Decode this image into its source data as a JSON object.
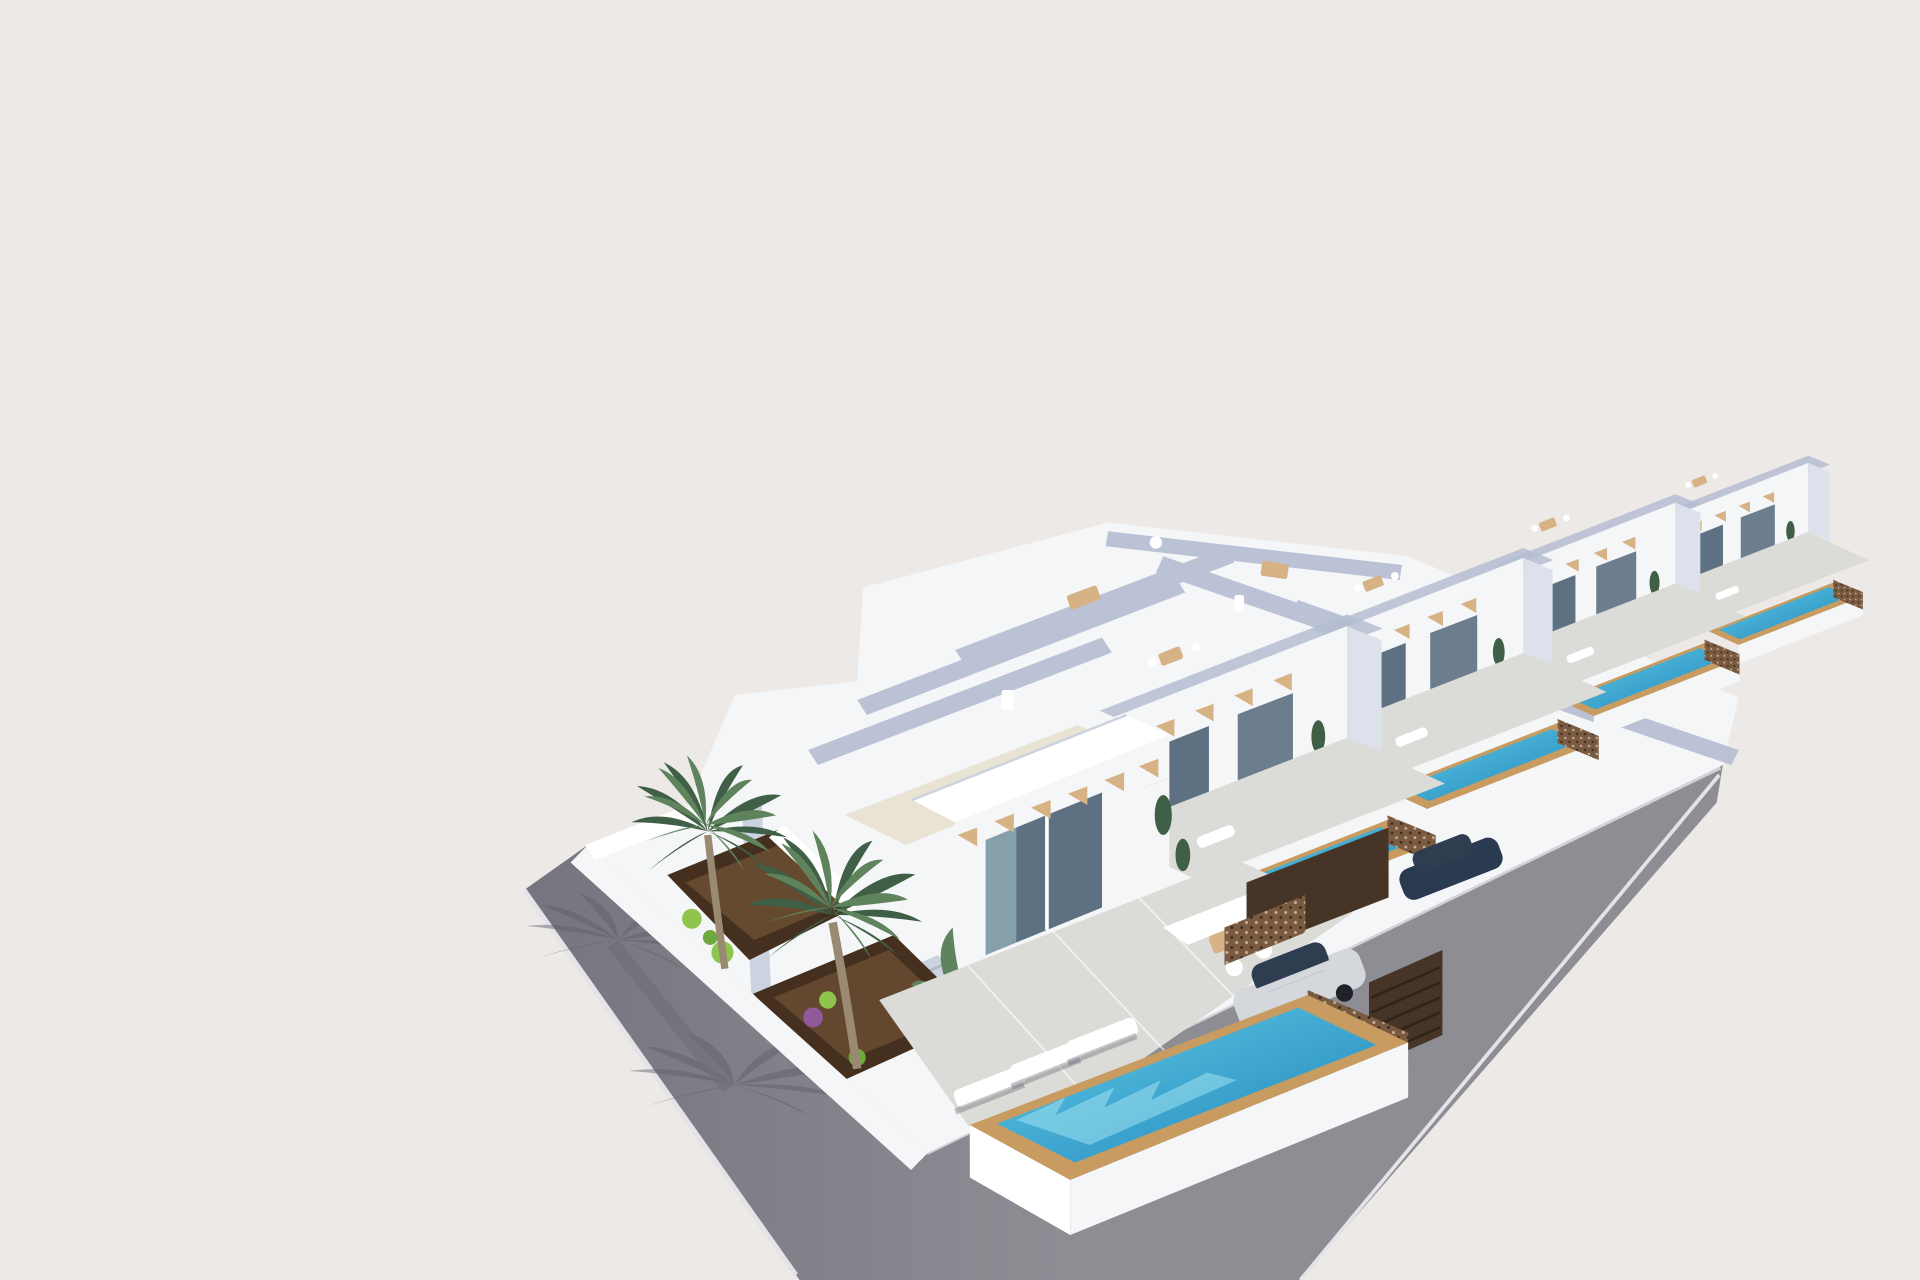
{
  "scene": {
    "title": "3D exterior rendering of a row of modern white villas with private pools beside a paved street",
    "elements": {
      "background": "plain warm-grey sky backdrop",
      "road": "grey paved street and sidewalk wrapping the corner of the plot",
      "palm_shadow": "palm tree shadows cast on the pavement",
      "villa_block": "row of five terraced white villas receding to the right",
      "villa_front": "nearest corner villa with garden, terrace and large pool",
      "garden": "walled gravel garden beds with shrubs and palm trees",
      "palm_trees": "two tall palm trees in the corner garden",
      "roof_terrace": "roof terraces with parapets, loungers and dining sets",
      "terrace": "ground-floor tiled terrace with sun loungers and lounge set",
      "pool_front": "large turquoise pool with tan wooden deck edge",
      "pools_row": "narrow private pools of the neighbouring villas",
      "lattice_fence": "perforated bronze privacy fence panels",
      "car_silver": "silver car parked in the open carport",
      "car_dark": "dark car parked at the second villa",
      "gate": "dark slatted carport gates",
      "facade": "white facades with glass doors and wooden pergola brackets"
    }
  },
  "colors": {
    "bg": "#EDE9E7",
    "road": "#8E8D94",
    "roadDark": "#76747E",
    "curb": "#E4E4E8",
    "shadow": "#5E5D6A",
    "blockWhite": "#F5F6F8",
    "white": "#FFFFFF",
    "wallShade": "#CBD2E0",
    "wallShade2": "#DCE1EB",
    "parapet": "#B5BDD2",
    "roofBeige": "#E9E3D3",
    "glassDark": "#5D7182",
    "glassLight": "#A8C6CE",
    "wood": "#D7B285",
    "deckTan": "#C89B60",
    "water1": "#63CBE4",
    "water2": "#1E85BD",
    "ripple": "#A5E6F2",
    "lattice": "#7A5B41",
    "gateDark": "#463527",
    "soil": "#45301F",
    "soilLight": "#7C5B3B",
    "leaf": "#5F835C",
    "leafDark": "#3F5F46",
    "leafBright": "#8FC44F",
    "purple": "#91589A",
    "tile": "#DBDCD7",
    "carSilver": "#D4D7DC",
    "carGlass": "#2F3D50",
    "carDark": "#2A3A50",
    "trunk": "#9A8A72"
  }
}
